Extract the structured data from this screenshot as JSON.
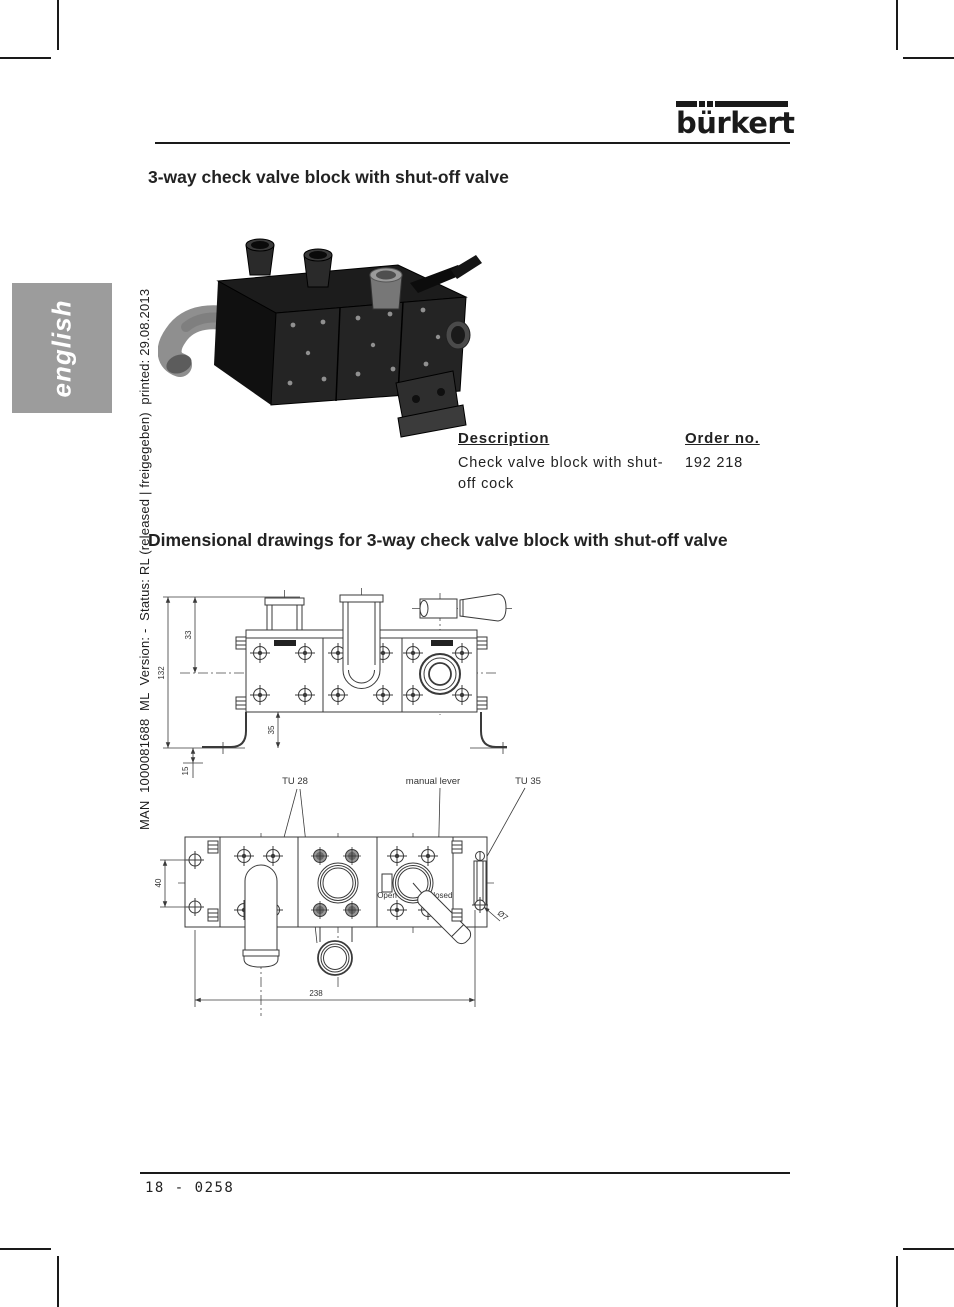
{
  "page": {
    "language_tab": "english",
    "meta_vertical": "MAN  1000081688  ML  Version: -  Status: RL (released | freigegeben)  printed: 29.08.2013",
    "footer": "18 - 0258"
  },
  "logo": {
    "wordmark": "bürkert"
  },
  "product_section": {
    "title": "3-way check valve block with shut-off valve"
  },
  "order_table": {
    "description_header": "Description",
    "order_no_header": "Order no.",
    "rows": [
      {
        "description": "Check valve block with shut-off cock",
        "order_no": "192 218"
      }
    ]
  },
  "drawings_section": {
    "title": "Dimensional drawings for 3-way check valve block with shut-off valve"
  },
  "drawing_front": {
    "dim_overall_height": "132",
    "dim_top_to_center": "33",
    "dim_body_to_base": "35",
    "dim_base_plate": "15"
  },
  "drawing_top": {
    "label_tu28": "TU 28",
    "label_manual_lever": "manual lever",
    "label_tu35": "TU 35",
    "label_open": "Open",
    "label_closed": "Closed",
    "label_diameter": "Ø7",
    "dim_hole_spacing": "40",
    "dim_overall_width": "238"
  }
}
